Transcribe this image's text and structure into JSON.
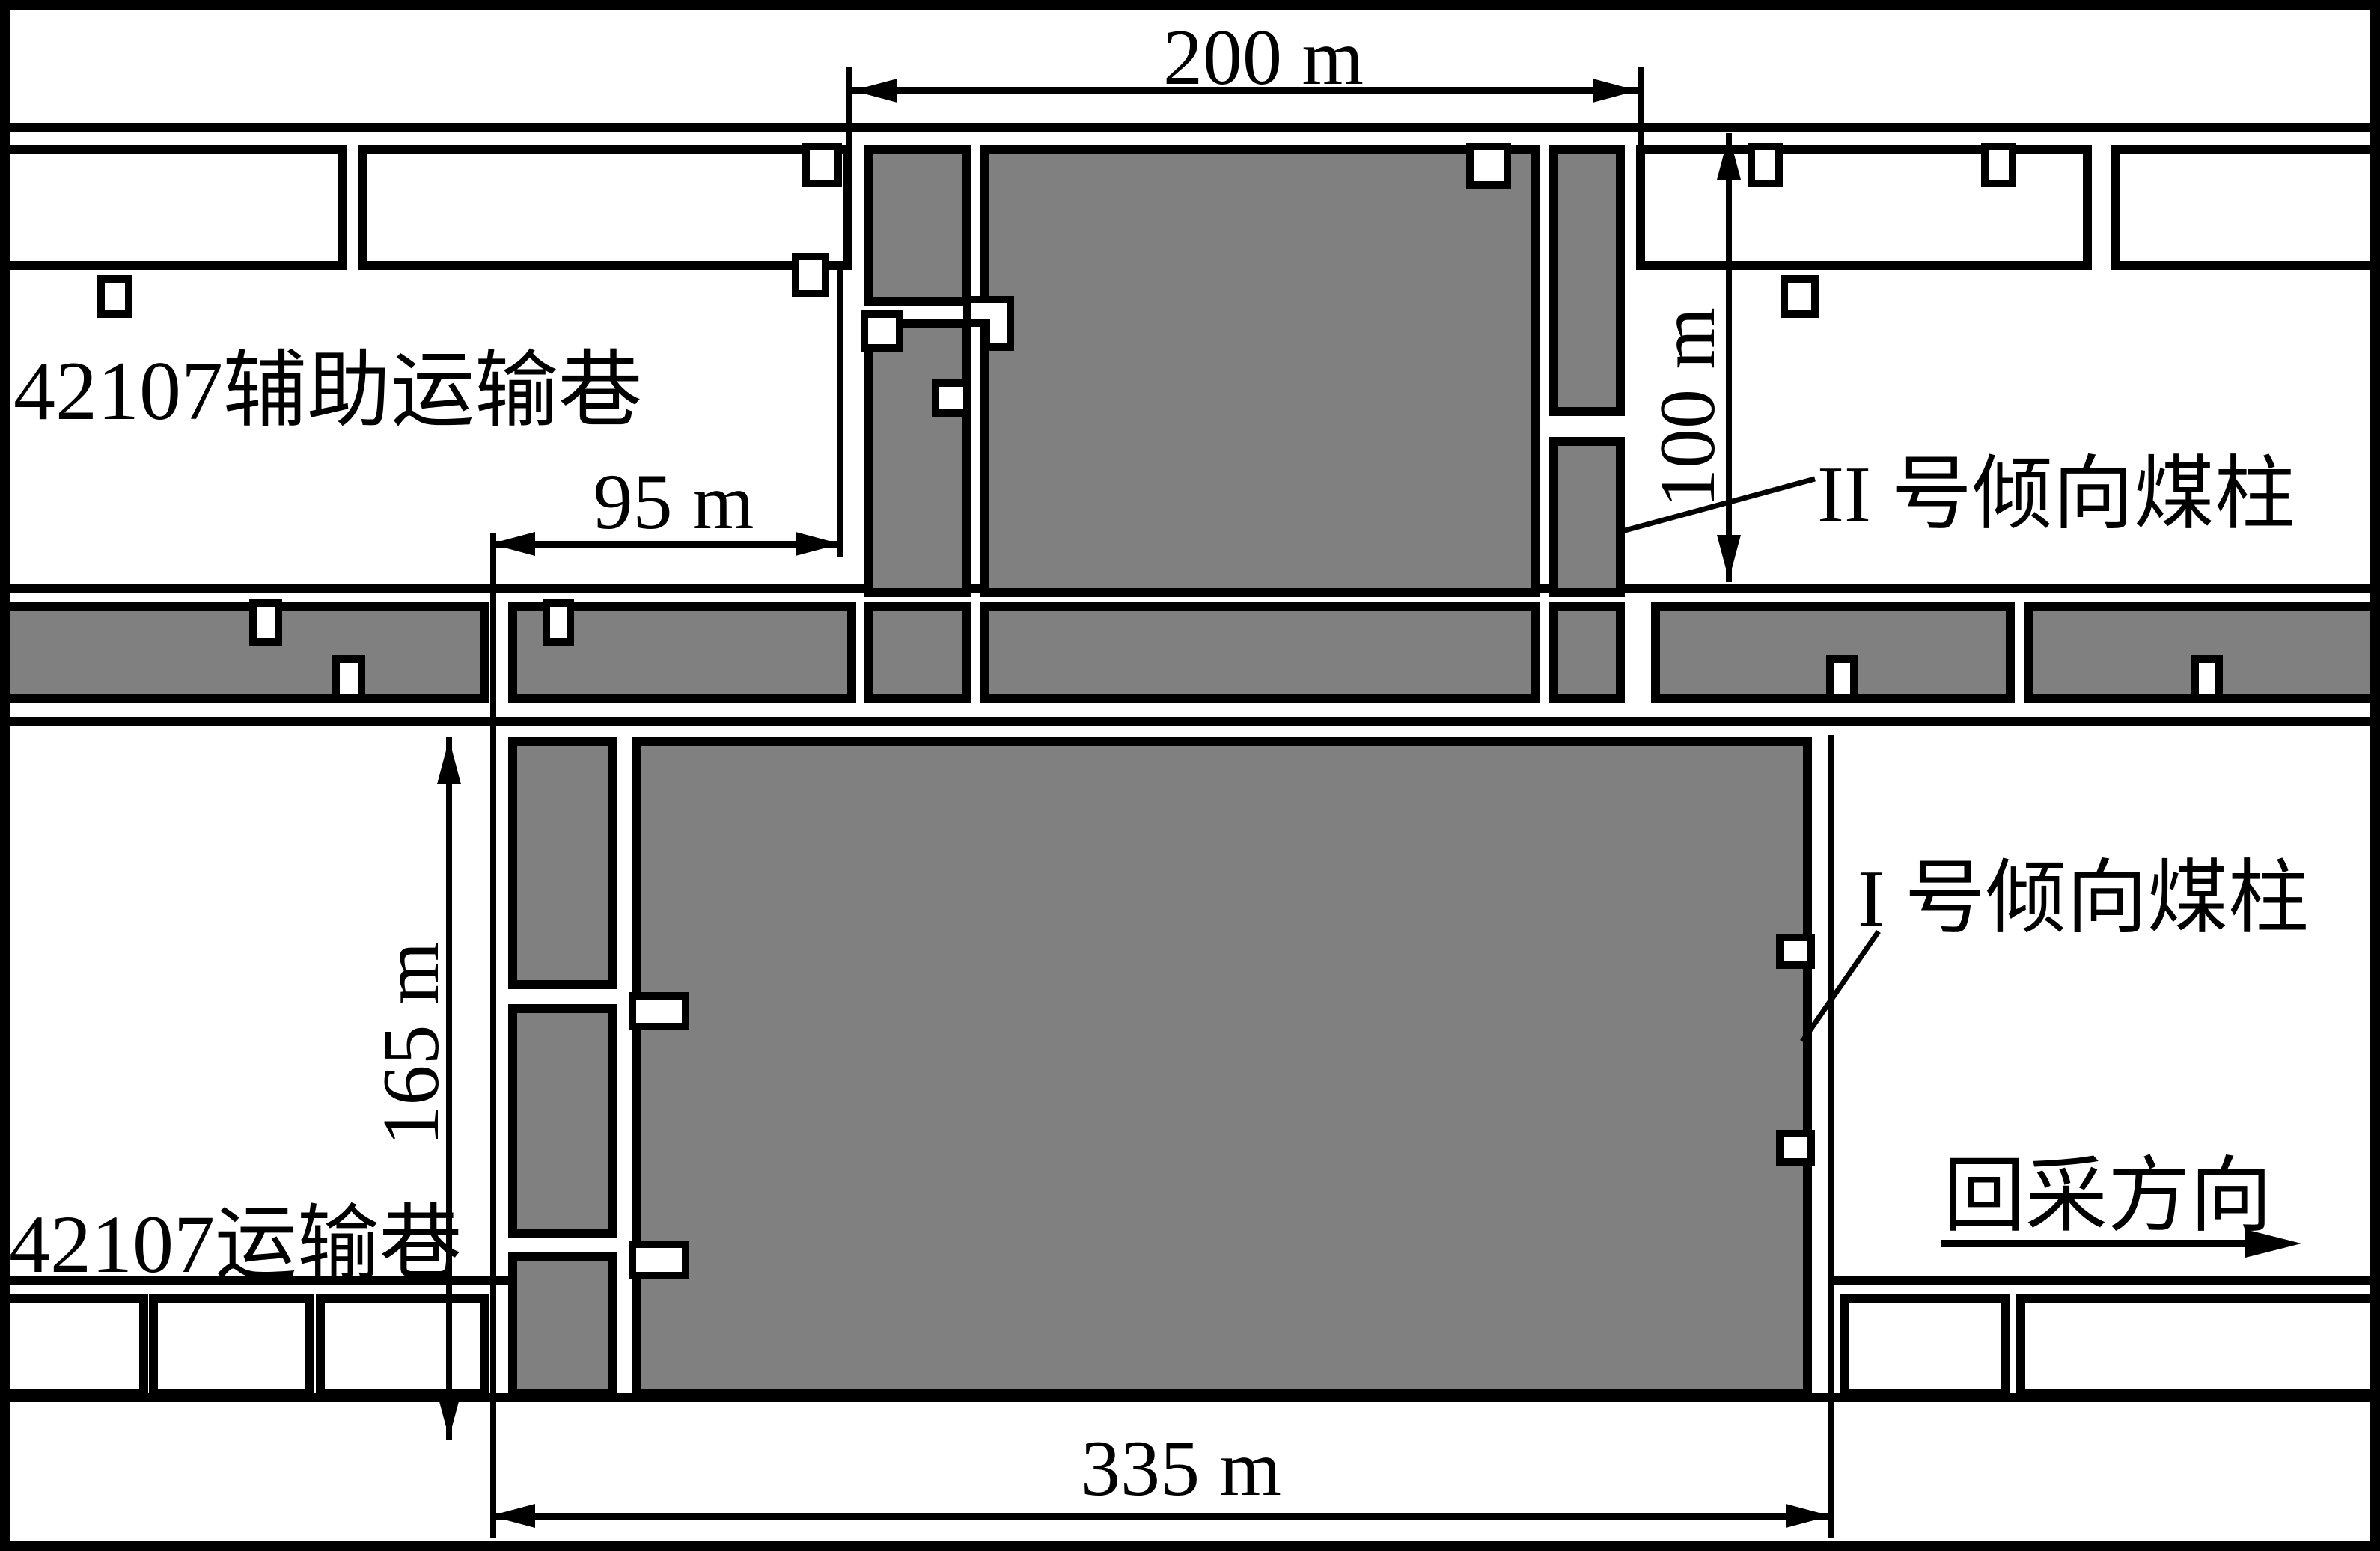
{
  "figure": {
    "type": "mine-working-face-layout-diagram",
    "labels": {
      "aux_roadway": "42107辅助运输巷",
      "transport_roadway": "42107运输巷",
      "pillar2": "II 号倾向煤柱",
      "pillar1": "I 号倾向煤柱",
      "mining_direction": "回采方向"
    },
    "dimensions": {
      "top_span": "200 m",
      "upper_left_span": "95 m",
      "pillar2_width": "100 m",
      "pillar1_width": "165 m",
      "bottom_span": "335 m"
    },
    "colors": {
      "coal_pillar_fill": "#808080",
      "line": "#000000",
      "background": "#ffffff"
    }
  }
}
